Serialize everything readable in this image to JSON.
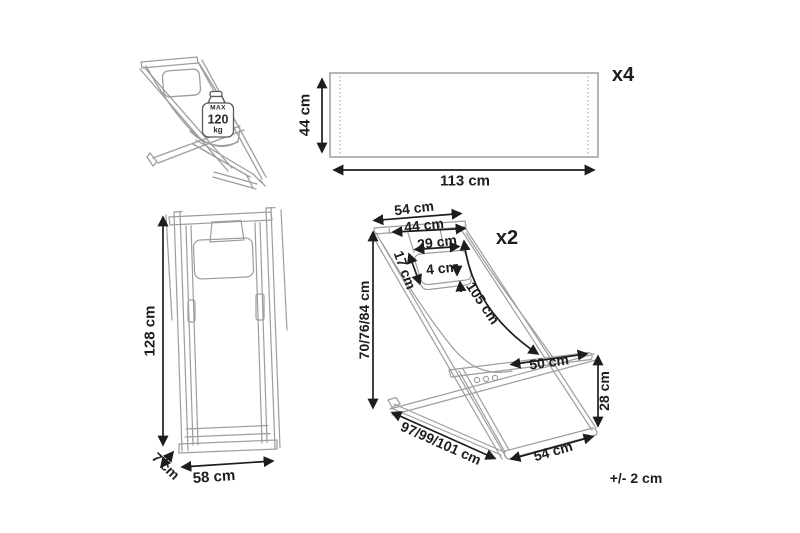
{
  "weight_capacity": {
    "prefix": "MAX",
    "value": "120",
    "unit": "kg"
  },
  "fabric_panel": {
    "quantity": "x4",
    "height": "44 cm",
    "width": "113 cm"
  },
  "front_view": {
    "height": "128 cm",
    "width": "58 cm",
    "depth": "7 cm"
  },
  "perspective_view": {
    "quantity": "x2",
    "top_width": "54 cm",
    "inner_width": "44 cm",
    "pillow_width": "29 cm",
    "pillow_depth": "17 cm",
    "pillow_thickness": "4 cm",
    "adjustable_height": "70/76/84 cm",
    "backrest_length": "105 cm",
    "seat_width": "50 cm",
    "seat_front_height": "28 cm",
    "total_depth": "97/99/101 cm",
    "base_width": "54 cm"
  },
  "tolerance_note": "+/- 2 cm",
  "colors": {
    "line_art": "#9d9d9d",
    "dimension": "#1d1d1b",
    "background": "#ffffff"
  }
}
